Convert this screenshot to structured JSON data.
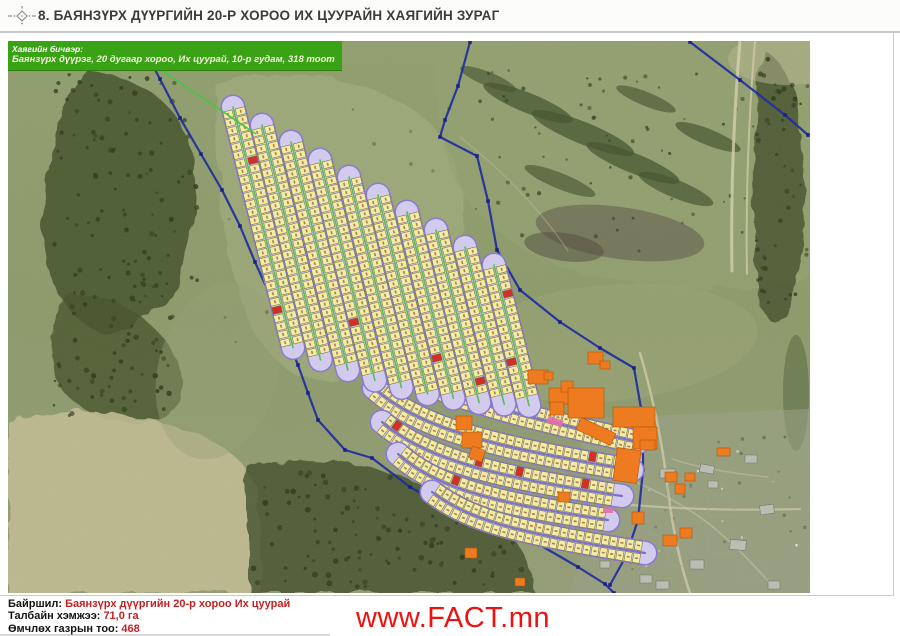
{
  "page": {
    "title": "8. БАЯНЗҮРХ ДҮҮРГИЙН 20-Р ХОРОО ИХ ЦУУРАЙН ХАЯГИЙН ЗУРАГ",
    "website": "www.FACT.mn"
  },
  "callout": {
    "label": "Хаягийн бичвэр:",
    "address": "Баянзүрх дүүрэг, 20 дугаар хороо, Их цуурай, 10-р гудам, 318 тоот"
  },
  "footer": {
    "location_label": "Байршил:",
    "location_value": "Баянзүрх дүүргийн 20-р хороо Их цуурай",
    "area_label": "Талбайн хэмжээ:",
    "area_value": "71,0 га",
    "count_label": "Өмчлөх газрын тоо:",
    "count_value": "468"
  },
  "colors": {
    "callout_green": "#3aa315",
    "callout_line_green": "#3ecb3e",
    "boundary_blue": "#1e2da0",
    "boundary_node": "#16208a",
    "street_purple": "#8a7ad0",
    "street_inner": "#d3cbee",
    "street_center_green": "#58bd58",
    "street_center_purple": "#7e70c8",
    "parcel_yellow": "#f3eca5",
    "parcel_border": "#74722e",
    "parcel_number": "#a05238",
    "parcel_red": "#d03028",
    "building_orange": "#ee7b20",
    "building_border": "#b45708",
    "pink": "#e070a8",
    "value_red": "#c22222",
    "link_red": "#ef1010"
  },
  "map": {
    "width": 802,
    "height": 552,
    "terrain": {
      "base": "#8b9a6a",
      "zones": [
        {
          "kind": "path",
          "d": "M80,30 Q170,40 185,120 Q195,190 165,250 Q130,300 90,290 Q40,270 35,180 Q35,80 80,30 Z",
          "fill": "#3e4d28",
          "op": 0.8,
          "rough": true
        },
        {
          "kind": "path",
          "d": "M60,250 Q140,260 170,320 Q185,360 150,380 Q90,390 55,350 Q30,300 60,250 Z",
          "fill": "#44522c",
          "op": 0.8,
          "rough": true
        },
        {
          "kind": "path",
          "d": "M0,380 Q90,358 180,390 Q245,412 252,462 L252,552 L0,552 Z",
          "fill": "#c1bc93",
          "op": 0.9,
          "rough": true
        },
        {
          "kind": "path",
          "d": "M240,425 Q340,408 432,450 Q522,482 526,552 L240,552 Z",
          "fill": "#3f4e2a",
          "op": 0.8,
          "rough": true
        },
        {
          "kind": "path",
          "d": "M210,45 Q330,10 420,80 Q468,130 450,220 Q430,290 360,330 Q292,358 252,300 Q205,220 210,45 Z",
          "fill": "#a9b284",
          "op": 0.5,
          "rough": true
        },
        {
          "kind": "path",
          "d": "M430,0 L802,0 L802,238 Q700,258 600,238 Q500,218 452,150 Q422,80 430,0 Z",
          "fill": "#94a171",
          "op": 0.65,
          "rough": true
        },
        {
          "kind": "ellipse",
          "cx": 520,
          "cy": 62,
          "rx": 48,
          "ry": 10,
          "rot": 22,
          "fill": "#42532e",
          "op": 0.75
        },
        {
          "kind": "ellipse",
          "cx": 575,
          "cy": 92,
          "rx": 55,
          "ry": 11,
          "rot": 22,
          "fill": "#42532e",
          "op": 0.75
        },
        {
          "kind": "ellipse",
          "cx": 625,
          "cy": 122,
          "rx": 50,
          "ry": 10,
          "rot": 22,
          "fill": "#42532e",
          "op": 0.75
        },
        {
          "kind": "ellipse",
          "cx": 668,
          "cy": 148,
          "rx": 40,
          "ry": 9,
          "rot": 22,
          "fill": "#42532e",
          "op": 0.7
        },
        {
          "kind": "ellipse",
          "cx": 700,
          "cy": 96,
          "rx": 35,
          "ry": 8,
          "rot": 22,
          "fill": "#42532e",
          "op": 0.7
        },
        {
          "kind": "ellipse",
          "cx": 552,
          "cy": 140,
          "rx": 38,
          "ry": 8,
          "rot": 22,
          "fill": "#42532e",
          "op": 0.65
        },
        {
          "kind": "ellipse",
          "cx": 480,
          "cy": 38,
          "rx": 30,
          "ry": 7,
          "rot": 22,
          "fill": "#42532e",
          "op": 0.65
        },
        {
          "kind": "ellipse",
          "cx": 638,
          "cy": 58,
          "rx": 32,
          "ry": 7,
          "rot": 22,
          "fill": "#42532e",
          "op": 0.65
        },
        {
          "kind": "ellipse",
          "cx": 612,
          "cy": 192,
          "rx": 85,
          "ry": 26,
          "rot": 8,
          "fill": "#5c564a",
          "op": 0.55
        },
        {
          "kind": "ellipse",
          "cx": 556,
          "cy": 206,
          "rx": 40,
          "ry": 14,
          "rot": 8,
          "fill": "#4c4639",
          "op": 0.5
        },
        {
          "kind": "path",
          "d": "M755,8 Q792,28 796,120 Q800,200 780,262 Q762,300 752,258 Q736,140 755,8 Z",
          "fill": "#3c4a28",
          "op": 0.75,
          "rough": true
        },
        {
          "kind": "ellipse",
          "cx": 788,
          "cy": 352,
          "rx": 13,
          "ry": 58,
          "rot": 0,
          "fill": "#4a5a34",
          "op": 0.45
        },
        {
          "kind": "path",
          "d": "M566,378 L802,368 L802,552 L560,552 Q596,470 566,378 Z",
          "fill": "#9aa089",
          "op": 0.55
        },
        {
          "kind": "ellipse",
          "cx": 600,
          "cy": 302,
          "rx": 150,
          "ry": 58,
          "rot": -5,
          "fill": "#a2aa7a",
          "op": 0.35
        },
        {
          "kind": "ellipse",
          "cx": 780,
          "cy": 18,
          "rx": 60,
          "ry": 26,
          "rot": 0,
          "fill": "#b8b590",
          "op": 0.5
        },
        {
          "kind": "ellipse",
          "cx": 210,
          "cy": 330,
          "rx": 60,
          "ry": 90,
          "rot": 15,
          "fill": "#97a172",
          "op": 0.4
        }
      ],
      "tree_zones": [
        {
          "x": 45,
          "y": 30,
          "w": 145,
          "h": 235,
          "n": 100,
          "rmin": 1.2,
          "rmax": 2.8,
          "fill": "#2b3a1b",
          "op": 0.9
        },
        {
          "x": 45,
          "y": 255,
          "w": 120,
          "h": 120,
          "n": 55,
          "rmin": 1.2,
          "rmax": 2.8,
          "fill": "#2b3a1b",
          "op": 0.9
        },
        {
          "x": 245,
          "y": 428,
          "w": 275,
          "h": 118,
          "n": 120,
          "rmin": 1.2,
          "rmax": 3.0,
          "fill": "#2b3a1b",
          "op": 0.9
        },
        {
          "x": 462,
          "y": 25,
          "w": 290,
          "h": 185,
          "n": 60,
          "rmin": 1.0,
          "rmax": 2.2,
          "fill": "#32421f",
          "op": 0.8
        },
        {
          "x": 748,
          "y": 10,
          "w": 52,
          "h": 260,
          "n": 45,
          "rmin": 1.2,
          "rmax": 2.6,
          "fill": "#2b3a1b",
          "op": 0.85
        },
        {
          "x": 200,
          "y": 60,
          "w": 250,
          "h": 260,
          "n": 22,
          "rmin": 1.0,
          "rmax": 2.2,
          "fill": "#3a4a24",
          "op": 0.5
        },
        {
          "x": 560,
          "y": 390,
          "w": 240,
          "h": 160,
          "n": 25,
          "rmin": 1.0,
          "rmax": 2.0,
          "fill": "#4a5340",
          "op": 0.6
        },
        {
          "x": 620,
          "y": 408,
          "w": 170,
          "h": 130,
          "n": 12,
          "rmin": 0.8,
          "rmax": 1.4,
          "fill": "#e8e8e0",
          "op": 0.9
        }
      ],
      "roads": [
        {
          "d": "M732,0 Q722,120 724,230",
          "w": 3,
          "c": "#d5cfad",
          "op": 0.8
        },
        {
          "d": "M747,0 Q737,120 739,233",
          "w": 2,
          "c": "#d5cfad",
          "op": 0.7
        },
        {
          "d": "M632,312 Q652,380 660,450 Q668,512 682,552",
          "w": 2.5,
          "c": "#cfc9a7",
          "op": 0.8
        },
        {
          "d": "M532,452 Q640,472 792,468",
          "w": 2.2,
          "c": "#cfc9a7",
          "op": 0.7
        },
        {
          "d": "M600,430 Q660,452 700,482 Q730,506 760,540",
          "w": 1.5,
          "c": "#c9c3a2",
          "op": 0.6
        },
        {
          "d": "M664,418 Q700,430 760,436",
          "w": 1.5,
          "c": "#c9c3a2",
          "op": 0.5
        },
        {
          "d": "M452,96 Q520,150 560,210",
          "w": 1.2,
          "c": "#c9c3a2",
          "op": 0.4
        }
      ],
      "settlement_buildings": [
        [
          617,
          414,
          18,
          10,
          -5
        ],
        [
          652,
          428,
          15,
          9,
          0
        ],
        [
          692,
          424,
          14,
          8,
          10
        ],
        [
          737,
          414,
          12,
          8,
          0
        ],
        [
          700,
          440,
          10,
          7,
          0
        ],
        [
          752,
          464,
          14,
          9,
          -8
        ],
        [
          722,
          499,
          16,
          10,
          5
        ],
        [
          682,
          519,
          14,
          9,
          0
        ],
        [
          632,
          534,
          12,
          8,
          0
        ],
        [
          592,
          520,
          10,
          7,
          0
        ],
        [
          760,
          540,
          12,
          8,
          0
        ],
        [
          648,
          540,
          13,
          8,
          0
        ]
      ],
      "fences": [
        [
          610,
          430,
          30,
          22
        ],
        [
          660,
          445,
          28,
          20
        ],
        [
          700,
          455,
          26,
          20
        ],
        [
          640,
          470,
          30,
          24
        ],
        [
          700,
          490,
          28,
          22
        ],
        [
          660,
          505,
          26,
          20
        ],
        [
          730,
          520,
          28,
          20
        ],
        [
          610,
          500,
          24,
          20
        ]
      ]
    },
    "boundaries": [
      {
        "pts": [
          [
            132,
            1
          ],
          [
            152,
            38
          ],
          [
            172,
            77
          ],
          [
            193,
            113
          ],
          [
            214,
            149
          ],
          [
            232,
            185
          ],
          [
            247,
            221
          ],
          [
            261,
            252
          ],
          [
            270,
            279
          ],
          [
            281,
            302
          ],
          [
            290,
            324
          ],
          [
            300,
            352
          ],
          [
            310,
            379
          ],
          [
            337,
            409
          ],
          [
            364,
            417
          ],
          [
            402,
            446
          ],
          [
            439,
            467
          ],
          [
            482,
            483
          ],
          [
            532,
            504
          ],
          [
            570,
            526
          ],
          [
            597,
            543
          ],
          [
            606,
            552
          ]
        ]
      },
      {
        "pts": [
          [
            462,
            1
          ],
          [
            450,
            45
          ],
          [
            437,
            79
          ],
          [
            432,
            96
          ],
          [
            469,
            115
          ],
          [
            480,
            160
          ],
          [
            489,
            209
          ],
          [
            512,
            249
          ],
          [
            552,
            281
          ],
          [
            592,
            307
          ],
          [
            626,
            327
          ],
          [
            635,
            379
          ],
          [
            635,
            429
          ],
          [
            630,
            479
          ],
          [
            618,
            515
          ],
          [
            602,
            544
          ]
        ]
      },
      {
        "pts": [
          [
            682,
            1
          ],
          [
            732,
            39
          ],
          [
            777,
            74
          ],
          [
            800,
            94
          ]
        ]
      }
    ],
    "parcels": {
      "row_angle": 14,
      "rows": [
        {
          "x": 225,
          "y": 66,
          "len": 248
        },
        {
          "x": 254,
          "y": 84,
          "len": 242
        },
        {
          "x": 283,
          "y": 101,
          "len": 235
        },
        {
          "x": 312,
          "y": 119,
          "len": 227
        },
        {
          "x": 341,
          "y": 136,
          "len": 217
        },
        {
          "x": 370,
          "y": 154,
          "len": 205
        },
        {
          "x": 399,
          "y": 171,
          "len": 192
        },
        {
          "x": 428,
          "y": 189,
          "len": 178
        },
        {
          "x": 457,
          "y": 206,
          "len": 162
        },
        {
          "x": 486,
          "y": 224,
          "len": 145
        }
      ],
      "arcs": [
        {
          "p": [
            372,
            314,
            412,
            349,
            492,
            371,
            630,
            401
          ]
        },
        {
          "p": [
            366,
            347,
            412,
            389,
            492,
            407,
            624,
            429
          ]
        },
        {
          "p": [
            374,
            381,
            420,
            421,
            497,
            437,
            614,
            455
          ]
        },
        {
          "p": [
            390,
            413,
            432,
            451,
            502,
            464,
            600,
            479
          ]
        },
        {
          "p": [
            424,
            451,
            464,
            481,
            512,
            492,
            637,
            512
          ]
        }
      ]
    },
    "buildings": [
      [
        520,
        329,
        20,
        14,
        0
      ],
      [
        541,
        347,
        20,
        16,
        0
      ],
      [
        553,
        340,
        12,
        11,
        0
      ],
      [
        560,
        347,
        36,
        30,
        0
      ],
      [
        542,
        361,
        14,
        13,
        0
      ],
      [
        569,
        384,
        38,
        13,
        25
      ],
      [
        605,
        366,
        42,
        20,
        0
      ],
      [
        625,
        386,
        24,
        22,
        0
      ],
      [
        607,
        408,
        24,
        33,
        8
      ],
      [
        580,
        311,
        15,
        12,
        0
      ],
      [
        592,
        320,
        10,
        8,
        0
      ],
      [
        632,
        399,
        15,
        10,
        0
      ],
      [
        709,
        407,
        13,
        8,
        0
      ],
      [
        657,
        431,
        12,
        10,
        0
      ],
      [
        677,
        432,
        10,
        8,
        0
      ],
      [
        667,
        443,
        10,
        10,
        0
      ],
      [
        624,
        471,
        12,
        12,
        0
      ],
      [
        655,
        494,
        14,
        11,
        0
      ],
      [
        672,
        487,
        12,
        10,
        0
      ],
      [
        550,
        451,
        12,
        10,
        0
      ],
      [
        457,
        507,
        12,
        10,
        0
      ],
      [
        507,
        537,
        10,
        8,
        0
      ],
      [
        448,
        375,
        16,
        14,
        0
      ],
      [
        454,
        391,
        20,
        16,
        0
      ],
      [
        462,
        407,
        14,
        12,
        20
      ],
      [
        536,
        331,
        9,
        8,
        0
      ]
    ],
    "pink_segments": [
      [
        539,
        377,
        16,
        7,
        20
      ],
      [
        595,
        466,
        10,
        6,
        0
      ]
    ],
    "callout_line": {
      "x1": 150,
      "y1": 27,
      "x2": 248,
      "y2": 93
    }
  }
}
